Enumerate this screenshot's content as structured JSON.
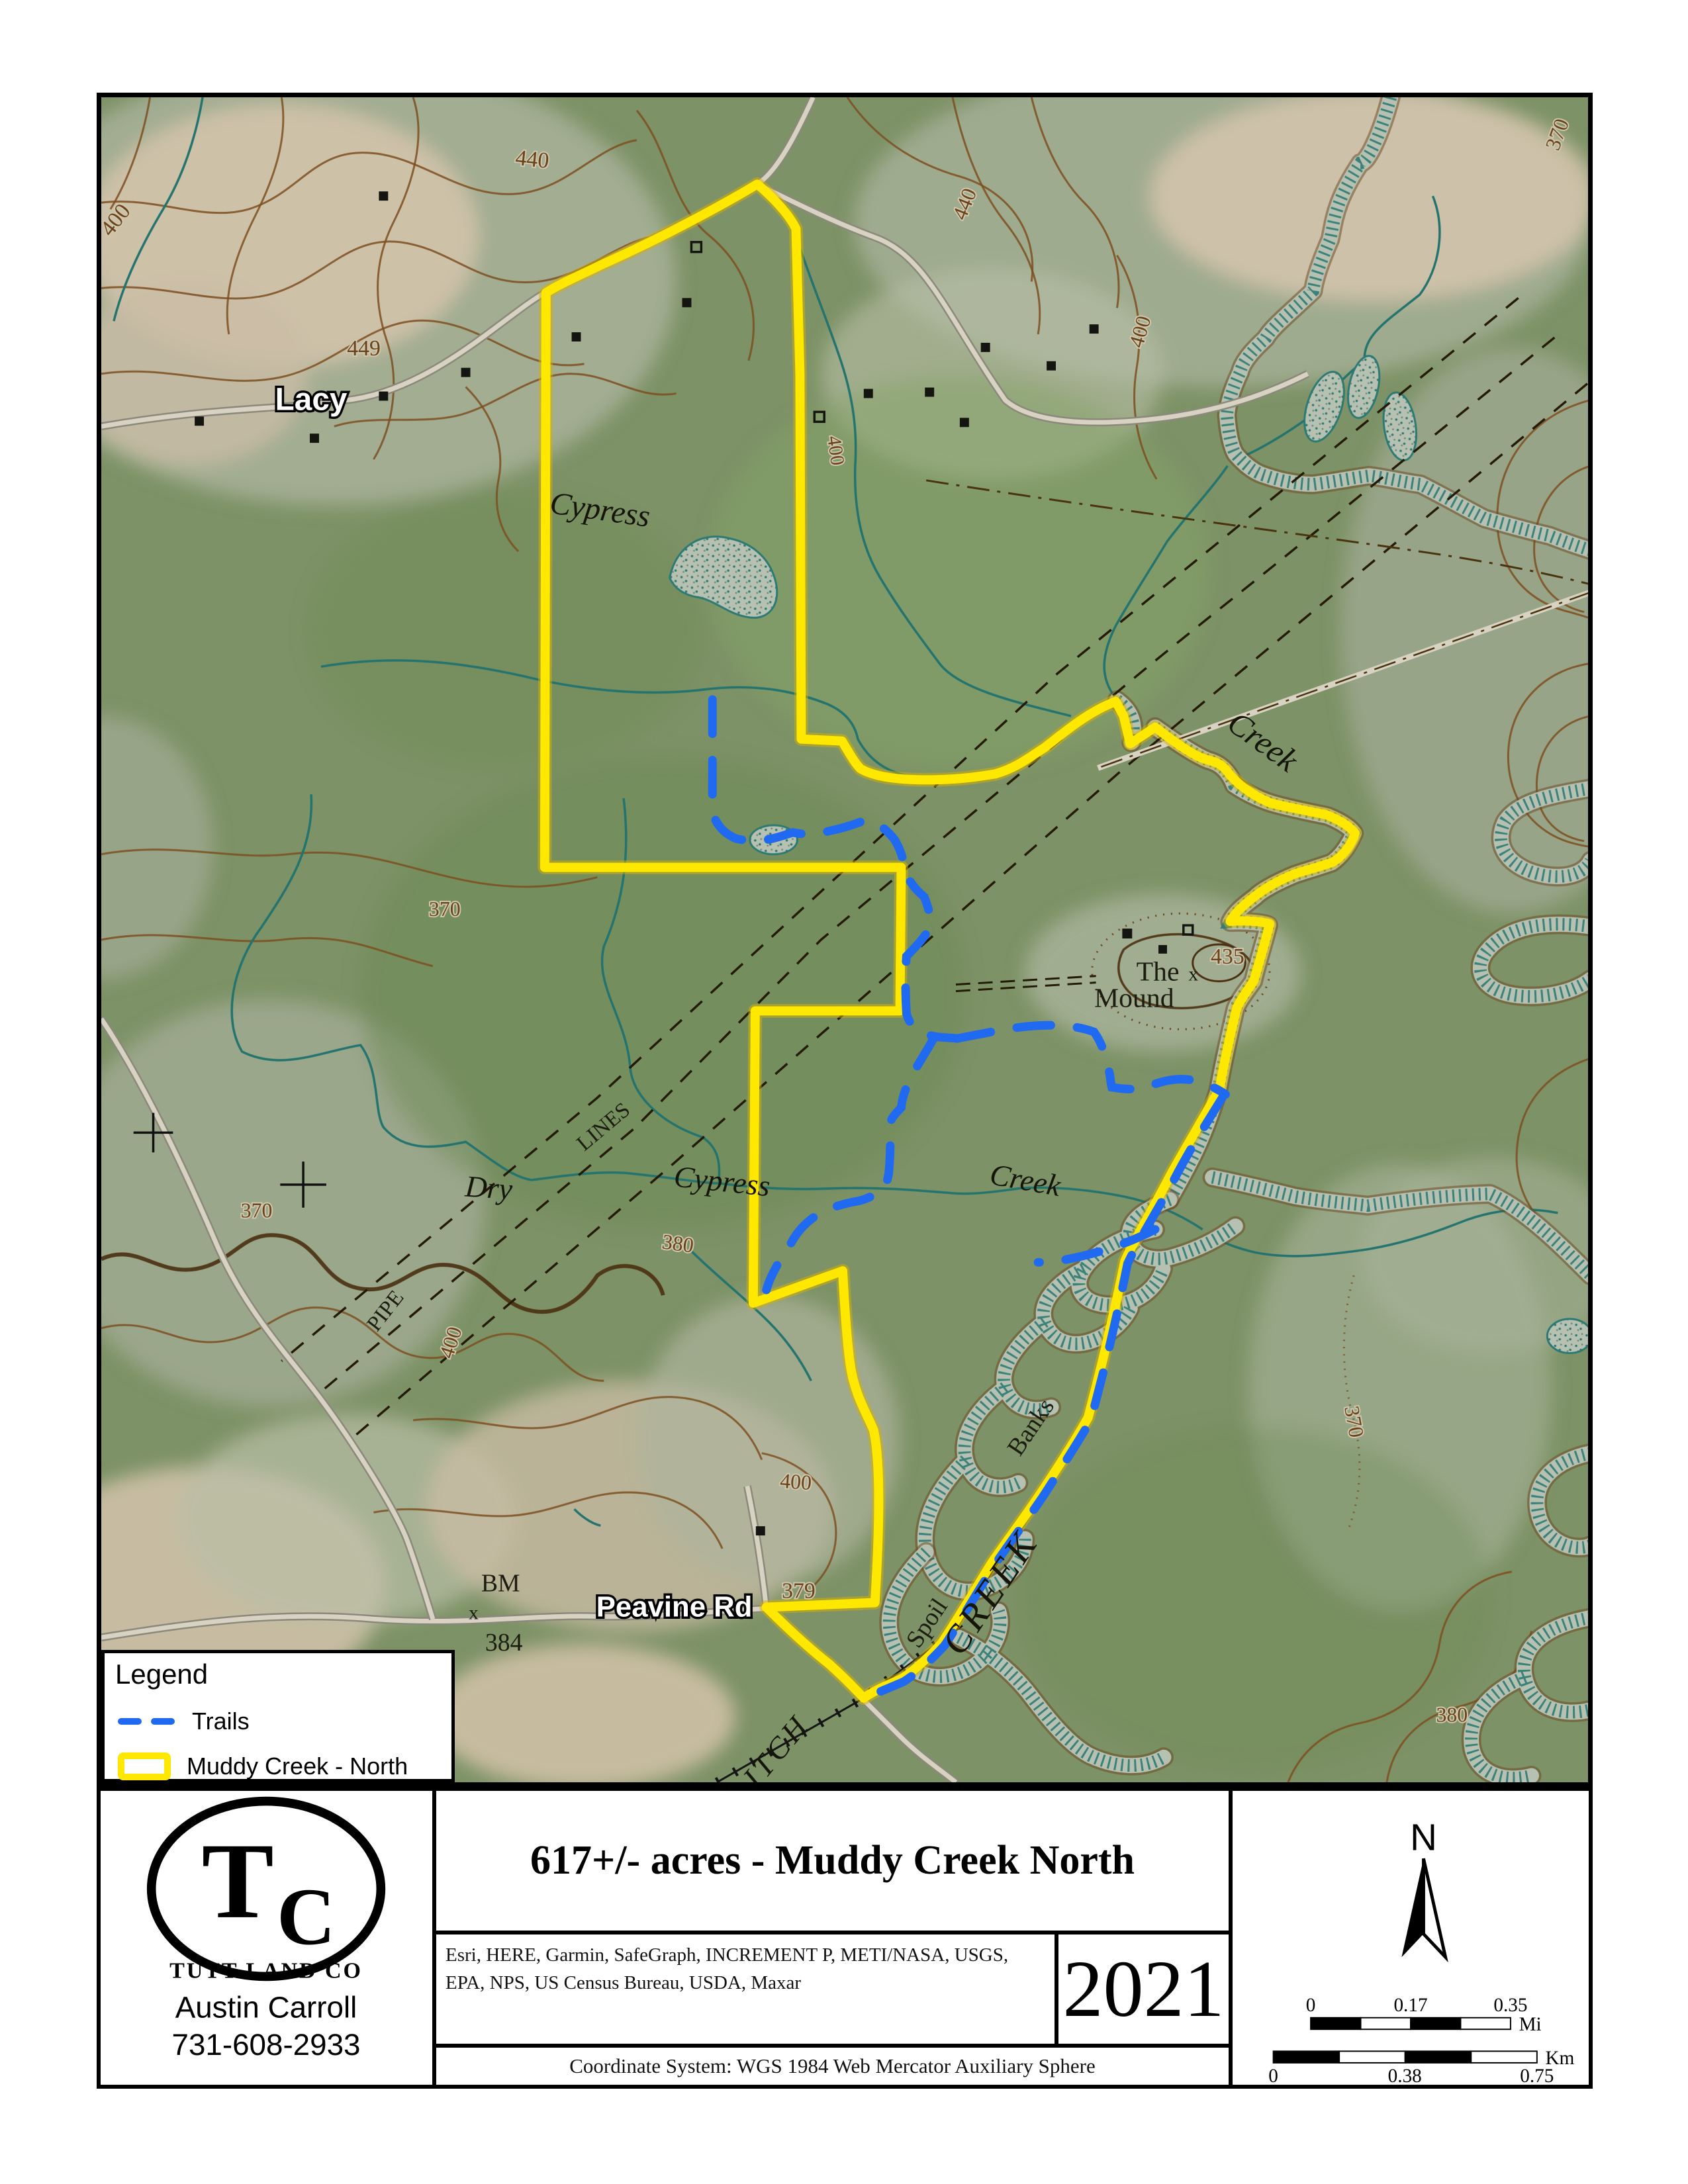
{
  "map": {
    "labels": [
      {
        "id": "lacy",
        "text": "Lacy"
      },
      {
        "id": "c449",
        "text": "449"
      },
      {
        "id": "c440-top",
        "text": "440"
      },
      {
        "id": "c400-left",
        "text": "400"
      },
      {
        "id": "c400-midright",
        "text": "400"
      },
      {
        "id": "cypress-upper",
        "text": "Cypress"
      },
      {
        "id": "creek-upper",
        "text": "Creek"
      },
      {
        "id": "the",
        "text": "The"
      },
      {
        "id": "mound",
        "text": "Mound"
      },
      {
        "id": "c435",
        "text": "435"
      },
      {
        "id": "mound-x",
        "text": "x"
      },
      {
        "id": "dry",
        "text": "Dry"
      },
      {
        "id": "cypress-lower",
        "text": "Cypress"
      },
      {
        "id": "creek-lower",
        "text": "Creek"
      },
      {
        "id": "lines",
        "text": "LINES"
      },
      {
        "id": "pipe",
        "text": "PIPE"
      },
      {
        "id": "c370-a",
        "text": "370"
      },
      {
        "id": "c370-b",
        "text": "370"
      },
      {
        "id": "c380-a",
        "text": "380"
      },
      {
        "id": "c400-c",
        "text": "400"
      },
      {
        "id": "bm",
        "text": "BM"
      },
      {
        "id": "bm-x",
        "text": "x"
      },
      {
        "id": "c384",
        "text": "384"
      },
      {
        "id": "peavine-rd",
        "text": "Peavine Rd"
      },
      {
        "id": "c379",
        "text": "379"
      },
      {
        "id": "c400-d",
        "text": "400"
      },
      {
        "id": "spoil",
        "text": "Spoil"
      },
      {
        "id": "banks",
        "text": "Banks"
      },
      {
        "id": "creek-caps",
        "text": "CREEK"
      },
      {
        "id": "itch",
        "text": "ITCH"
      },
      {
        "id": "c370-c",
        "text": "370"
      },
      {
        "id": "c380-b",
        "text": "380"
      },
      {
        "id": "c370-d",
        "text": "370"
      },
      {
        "id": "c440-right",
        "text": "440"
      },
      {
        "id": "c400-e",
        "text": "400"
      }
    ],
    "legend": {
      "title": "Legend",
      "items": [
        {
          "label": "Trails"
        },
        {
          "label": "Muddy Creek - North"
        }
      ]
    }
  },
  "footer": {
    "title": "617+/- acres - Muddy Creek North",
    "attribution_line1": "Esri, HERE, Garmin, SafeGraph, INCREMENT P, METI/NASA, USGS,",
    "attribution_line2": "EPA, NPS, US Census Bureau, USDA, Maxar",
    "year": "2021",
    "coordinate_system": "Coordinate System: WGS 1984 Web Mercator Auxiliary Sphere",
    "logo": {
      "monogram_t": "T",
      "monogram_c": "C",
      "company": "TUTT LAND CO",
      "agent": "Austin Carroll",
      "phone": "731-608-2933"
    },
    "north_label": "N",
    "scale": {
      "mi": {
        "t0": "0",
        "t1": "0.17",
        "t2": "0.35",
        "unit": "Mi"
      },
      "km": {
        "t0": "0",
        "t1": "0.38",
        "t2": "0.75",
        "unit": "Km"
      }
    }
  },
  "colors": {
    "boundary": "#ffe800",
    "trail": "#1f6af0",
    "stream": "#23736e",
    "contour": "#7c4e1f"
  }
}
